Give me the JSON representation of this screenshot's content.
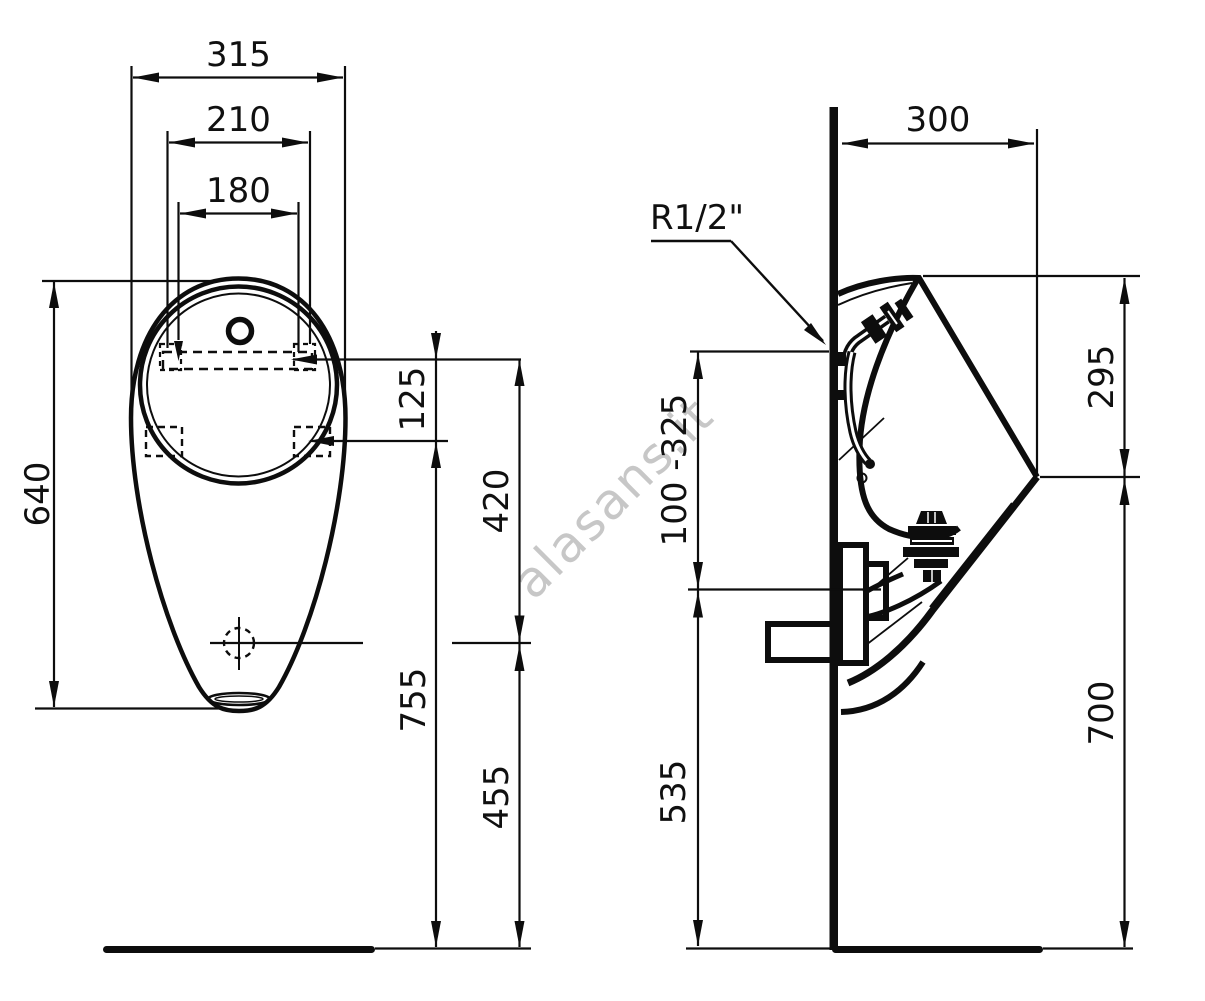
{
  "watermark": "alasans.it",
  "colors": {
    "line": "#0d0d0d",
    "watermark": "#c7c7c7"
  },
  "front_view": {
    "dims": {
      "overall_width": "315",
      "hanger_width": "210",
      "fixing_hole_spacing": "180",
      "overall_height": "640",
      "hanger_to_fixing_holes": "125",
      "hanger_to_outlet": "420",
      "fixing_holes_above_floor": "755",
      "outlet_above_floor": "455"
    }
  },
  "side_view": {
    "dims": {
      "depth_from_wall": "300",
      "water_inlet_thread": "R1/2\"",
      "rim_to_spout_drop": "295",
      "inlet_height_range": "100 -325",
      "waste_outlet_height": "535",
      "spout_above_floor": "700"
    }
  }
}
